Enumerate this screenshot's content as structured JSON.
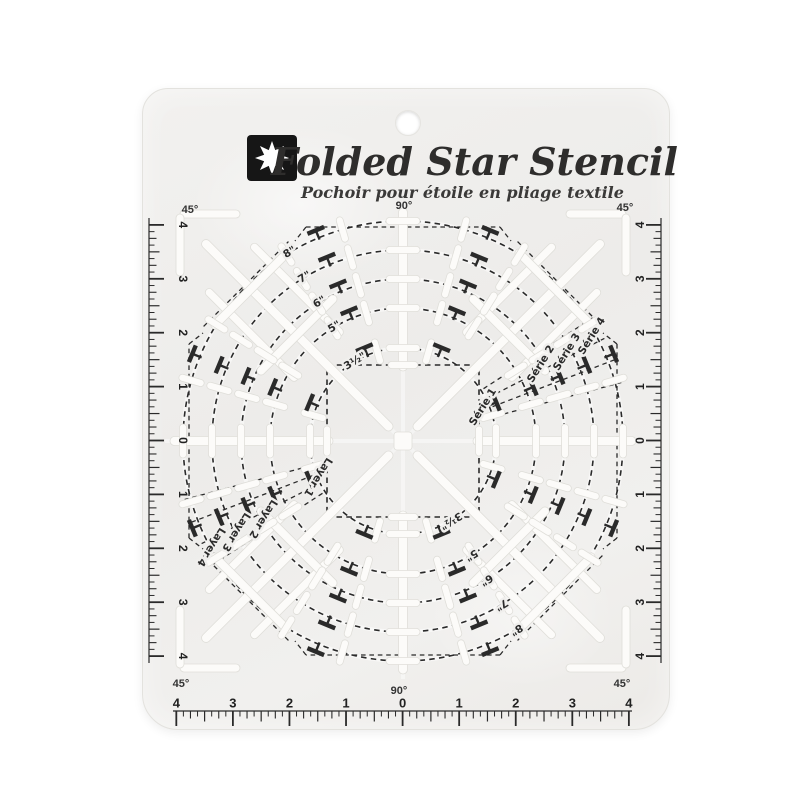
{
  "product_photo": {
    "brand_block": {
      "logo_icon": "eight-point-star-icon",
      "title": "Folded Star Stencil",
      "subtitle": "Pochoir pour étoile en pliage textile"
    },
    "angle_labels": {
      "top_center": "90°",
      "bottom_center": "90°",
      "top_left": "45°",
      "top_right": "45°",
      "bottom_left": "45°",
      "bottom_right": "45°"
    },
    "rulers": {
      "bottom": [
        "4",
        "3",
        "2",
        "1",
        "0",
        "1",
        "2",
        "3",
        "4"
      ],
      "left": [
        "4",
        "3",
        "2",
        "1",
        "0",
        "1",
        "2",
        "3",
        "4"
      ],
      "right": [
        "4",
        "3",
        "2",
        "1",
        "0",
        "1",
        "2",
        "3",
        "4"
      ]
    },
    "rings": [
      {
        "size_label": "3½\"",
        "series_label": "Série 1",
        "layer_label": "Layer 1"
      },
      {
        "size_label": "5\"",
        "series_label": "Série 2",
        "layer_label": "Layer 2"
      },
      {
        "size_label": "6\"",
        "series_label": "Série 3",
        "layer_label": "Layer 3"
      },
      {
        "size_label": "7\"",
        "series_label": "Série 4",
        "layer_label": "Layer 4"
      },
      {
        "size_label": "8\""
      }
    ],
    "colors": {
      "page_bg": "#ffffff",
      "plate": "#f0efed",
      "ink": "#2a2a2a",
      "slot_fill": "#fcfbf9",
      "slot_edge": "#dfded9",
      "logo_bg": "#161616",
      "logo_star": "#ffffff"
    }
  }
}
